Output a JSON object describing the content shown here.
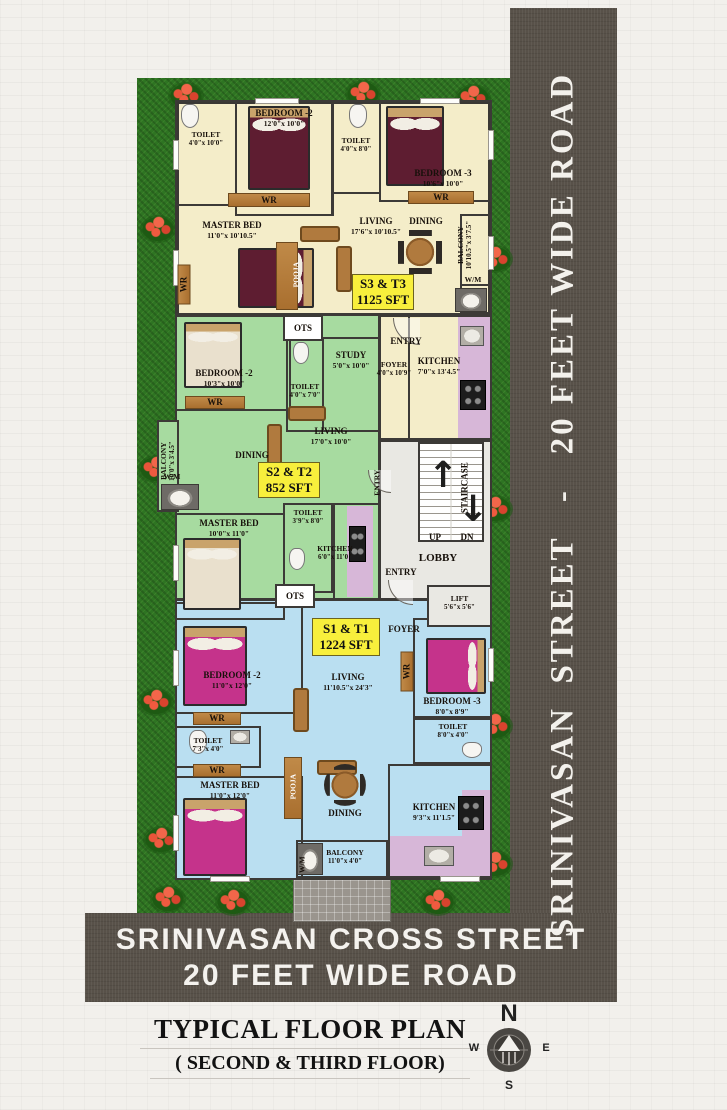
{
  "title": {
    "main": "TYPICAL FLOOR PLAN",
    "sub": "( SECOND & THIRD FLOOR)"
  },
  "roads": {
    "vertical": "SRINIVASAN  STREET   -   20 FEET WIDE ROAD",
    "bottom_line1": "SRINIVASAN CROSS STREET",
    "bottom_line2": "20 FEET WIDE ROAD"
  },
  "compass": {
    "n": "N",
    "e": "E",
    "s": "S",
    "w": "W"
  },
  "fixtures": {
    "wr": "WR",
    "wm": "W/M",
    "ots": "OTS",
    "pooja": "POOJA",
    "entry": "ENTRY"
  },
  "common": {
    "staircase": "STAIRCASE",
    "up": "UP",
    "dn": "DN",
    "lobby": "LOBBY",
    "lift": {
      "name": "LIFT",
      "dims": "5'6\"x 5'6\""
    }
  },
  "unit_s3t3": {
    "badge": {
      "name": "S3 & T3",
      "area": "1125 SFT"
    },
    "toilet1": {
      "name": "TOILET",
      "dims": "4'0\"x 10'0\""
    },
    "bedroom2": {
      "name": "BEDROOM -2",
      "dims": "12'0\"x 10'0\""
    },
    "toilet2": {
      "name": "TOILET",
      "dims": "4'0\"x 8'0\""
    },
    "bedroom3": {
      "name": "BEDROOM -3",
      "dims": "10'6\"x 10'0\""
    },
    "master": {
      "name": "MASTER BED",
      "dims": "11'0\"x 10'10.5\""
    },
    "living": {
      "name": "LIVING",
      "dims": "17'6\"x 10'10.5\""
    },
    "dining": {
      "name": "DINING"
    },
    "balcony": {
      "name": "BALCONY",
      "dims": "10'10.5\"x 3'7.5\""
    },
    "foyer": {
      "name": "FOYER",
      "dims": "4'0\"x 10'9\""
    },
    "kitchen": {
      "name": "KITCHEN",
      "dims": "7'0\"x 13'4.5\""
    }
  },
  "unit_s2t2": {
    "badge": {
      "name": "S2 & T2",
      "area": "852 SFT"
    },
    "bedroom2": {
      "name": "BEDROOM -2",
      "dims": "10'3\"x 10'0\""
    },
    "study": {
      "name": "STUDY",
      "dims": "5'0\"x 10'0\""
    },
    "toilet1": {
      "name": "TOILET",
      "dims": "4'0\"x 7'0\""
    },
    "living": {
      "name": "LIVING",
      "dims": "17'0\"x 10'0\""
    },
    "dining": {
      "name": "DINING"
    },
    "balcony": {
      "name": "BALCONY",
      "dims": "10'0\"x 3'4.5\""
    },
    "toilet2": {
      "name": "TOILET",
      "dims": "3'9\"x 8'0\""
    },
    "master": {
      "name": "MASTER BED",
      "dims": "10'0\"x 11'0\""
    },
    "kitchen": {
      "name": "KITCHEN",
      "dims": "6'0\"x 11'0\""
    }
  },
  "unit_s1t1": {
    "badge": {
      "name": "S1 & T1",
      "area": "1224 SFT"
    },
    "foyer": {
      "name": "FOYER"
    },
    "bedroom2": {
      "name": "BEDROOM -2",
      "dims": "11'0\"x 12'0\""
    },
    "living": {
      "name": "LIVING",
      "dims": "11'10.5\"x 24'3\""
    },
    "bedroom3": {
      "name": "BEDROOM -3",
      "dims": "8'0\"x 8'9\""
    },
    "toilet_right": {
      "name": "TOILET",
      "dims": "8'0\"x 4'0\""
    },
    "toilet_left": {
      "name": "TOILET",
      "dims": "7'3\"x 4'0\""
    },
    "master": {
      "name": "MASTER BED",
      "dims": "11'0\"x 12'0\""
    },
    "dining": {
      "name": "DINING"
    },
    "kitchen": {
      "name": "KITCHEN",
      "dims": "9'3\"x 11'1.5\""
    },
    "balcony": {
      "name": "BALCONY",
      "dims": "11'0\"x 4'0\""
    }
  },
  "colors": {
    "unit_s3t3": "#f4edc9",
    "unit_s2t2": "#a7dba0",
    "unit_s1t1": "#badff1",
    "kitchen_counter": "#d7b7d8",
    "badge": "#f8ef3c",
    "road": "#585149",
    "grass": "#2e7422"
  }
}
